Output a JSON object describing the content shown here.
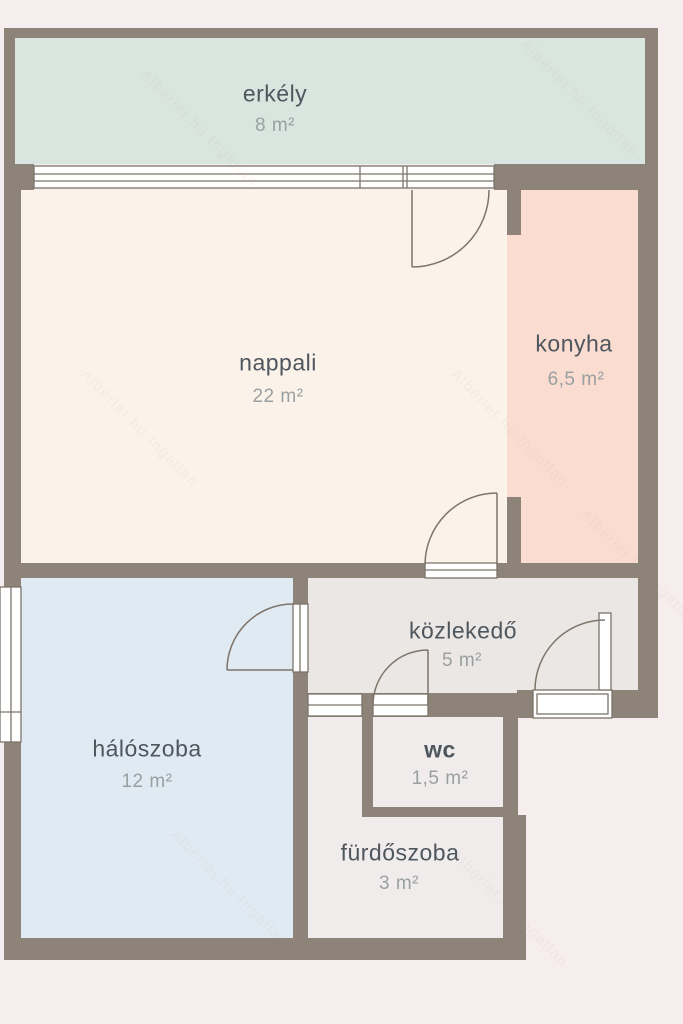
{
  "palette": {
    "background": "#f6edee",
    "wall": "#8d8378",
    "line": "#7d746a",
    "window": "#ffffff",
    "room_text": "#4e565e",
    "area_text": "#9aa0a2",
    "watermark_color": "rgba(171,134,126,0.17)"
  },
  "watermark": {
    "text": "Albérlet.hu Ingatlan"
  },
  "rooms": [
    {
      "id": "erkely",
      "name": "erkély",
      "area": "8 m²",
      "color": "#d9e5df"
    },
    {
      "id": "nappali",
      "name": "nappali",
      "area": "22 m²",
      "color": "#fbf2ea"
    },
    {
      "id": "konyha",
      "name": "konyha",
      "area": "6,5 m²",
      "color": "#fadcd0"
    },
    {
      "id": "haloszoba",
      "name": "hálószoba",
      "area": "12 m²",
      "color": "#e0eaf2"
    },
    {
      "id": "kozlekedo",
      "name": "közlekedő",
      "area": "5 m²",
      "color": "#eae7e5"
    },
    {
      "id": "wc",
      "name": "wc",
      "area": "1,5 m²",
      "color": "#f8edd3"
    },
    {
      "id": "furdoszoba",
      "name": "fürdőszoba",
      "area": "3 m²",
      "color": "#f0ecec"
    }
  ]
}
